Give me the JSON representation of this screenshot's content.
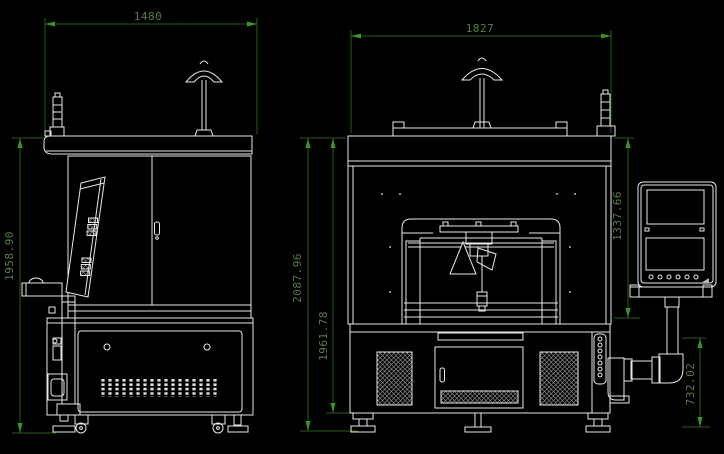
{
  "meta": {
    "type": "CAD engineering drawing",
    "views": [
      "machine side view",
      "machine front view"
    ]
  },
  "colors": {
    "background": "#000000",
    "line": "#e8e8e8",
    "dim_line": "#2b5c1b",
    "dim_arrow": "#3a9428",
    "dim_text": "#557d43"
  },
  "dimensions": {
    "side_width": {
      "value": "1480"
    },
    "side_height": {
      "value": "1958.90"
    },
    "front_width": {
      "value": "1827"
    },
    "front_overall_height": {
      "value": "2087.96"
    },
    "front_body_height": {
      "value": "1961.78"
    },
    "front_upper_height": {
      "value": "1337.66"
    },
    "front_arm_height": {
      "value": "732.02"
    }
  }
}
